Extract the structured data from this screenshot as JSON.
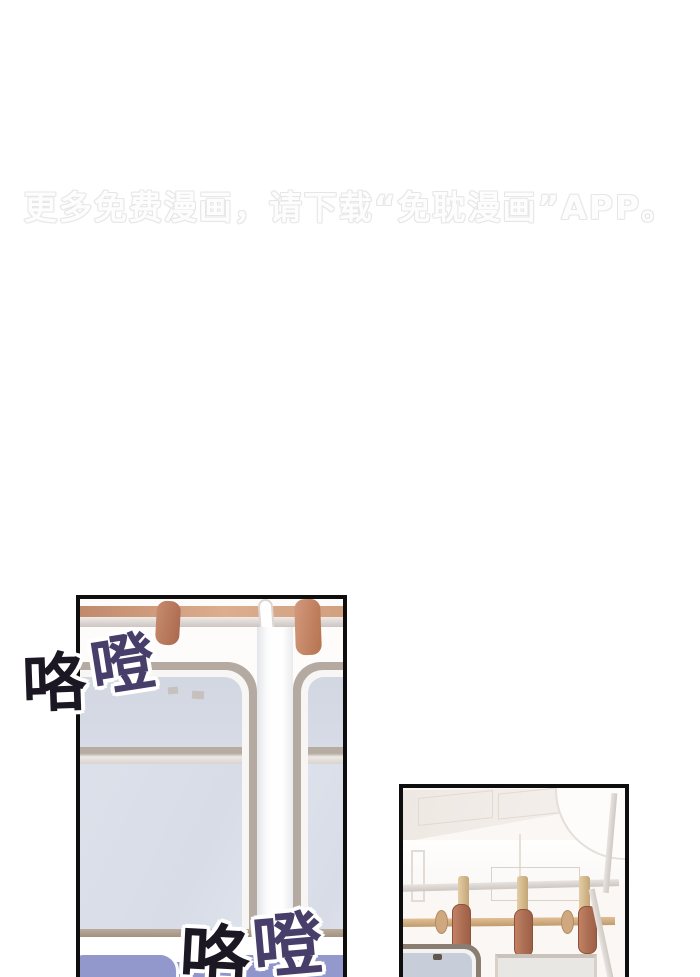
{
  "watermark": {
    "text": "更多免费漫画，请下载“免耽漫画”APP。"
  },
  "sfx": {
    "top_left": {
      "char1": "咯",
      "char2": "噔"
    },
    "bottom": {
      "char1": "咯",
      "char2": "噔"
    }
  },
  "colors": {
    "watermark_gray": "#e9e9e9",
    "panel_border": "#0e0e0e",
    "sfx_black": "#1b1824",
    "sfx_purple": "#473f6a",
    "sfx_outline": "#ffffff",
    "seat_blue": "#8d93c9",
    "strap_brown": "#b97f63",
    "rack_tan": "#cf9a7a",
    "bar_gold": "#cfa87c",
    "window_glass": "#d8dde8",
    "window_frame": "#b4aaa1"
  }
}
